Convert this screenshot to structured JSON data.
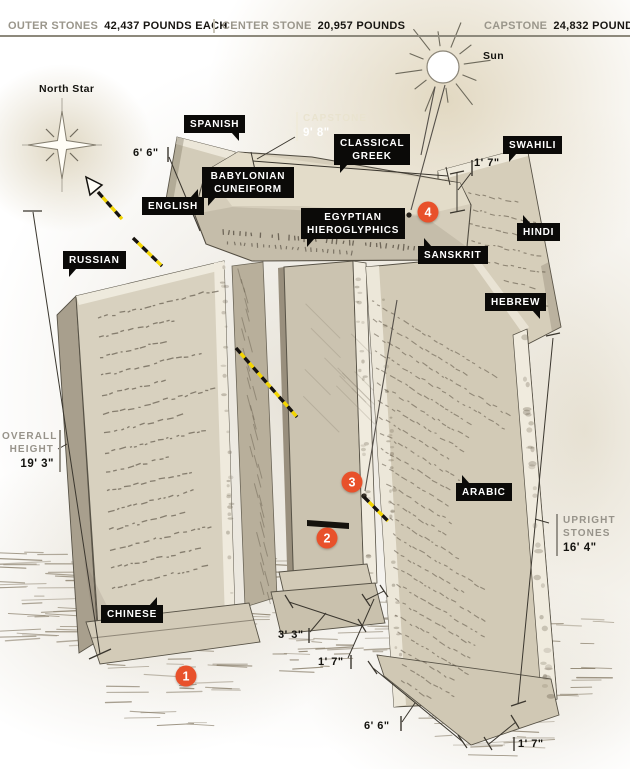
{
  "header": {
    "stats": [
      {
        "label": "OUTER STONES",
        "value": "42,437 POUNDS EACH"
      },
      {
        "label": "CENTER STONE",
        "value": "20,957 POUNDS"
      },
      {
        "label": "CAPSTONE",
        "value": "24,832 POUNDS"
      }
    ]
  },
  "sky": {
    "north_star": "North Star",
    "sun": "Sun"
  },
  "tags": {
    "spanish": "SPANISH",
    "classical_greek": "CLASSICAL GREEK",
    "babylonian": "BABYLONIAN CUNEIFORM",
    "english": "ENGLISH",
    "egyptian": "EGYPTIAN HIEROGLYPHICS",
    "sanskrit": "SANSKRIT",
    "swahili": "SWAHILI",
    "hindi": "HINDI",
    "russian": "RUSSIAN",
    "hebrew": "HEBREW",
    "arabic": "ARABIC",
    "chinese": "CHINESE"
  },
  "measurements": {
    "capstone_width": {
      "label": "CAPSTONE",
      "value": "9' 8\""
    },
    "overall_height": {
      "label_line1": "OVERALL",
      "label_line2": "HEIGHT",
      "value": "19' 3\""
    },
    "upright_stones": {
      "label_line1": "UPRIGHT",
      "label_line2": "STONES",
      "value": "16' 4\""
    },
    "capstone_length": "6' 6\"",
    "capstone_thickness": "1' 7\"",
    "center_width": "3' 3\"",
    "center_thickness": "1' 7\"",
    "upright_width": "6' 6\"",
    "upright_thickness": "1' 7\""
  },
  "markers": {
    "m1": "1",
    "m2": "2",
    "m3": "3",
    "m4": "4"
  },
  "colors": {
    "accent": "#e8512b",
    "tag_bg": "#0b0a08",
    "tag_fg": "#ffffff",
    "muted": "#97938a",
    "sightline": "#f2d400"
  }
}
